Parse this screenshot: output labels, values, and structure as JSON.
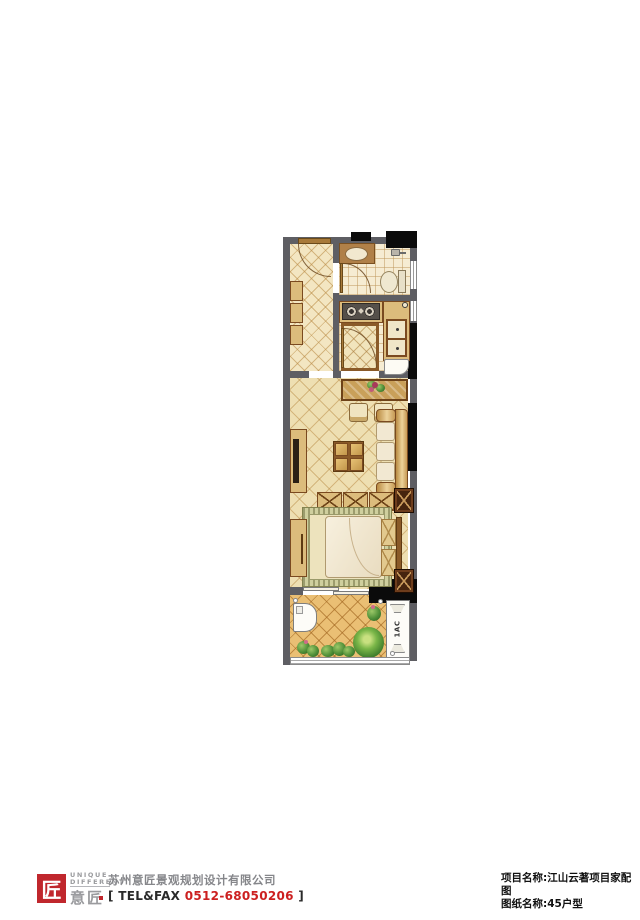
{
  "plan": {
    "ac_label": "1AC",
    "colors": {
      "wall_gray": "#5e5e63",
      "structural_black": "#0b0b0b",
      "entry_floor": "#f3e6c2",
      "living_floor": "#eedfb2",
      "bath_kitchen_tile": "#f6ecd2",
      "balcony_floor": "#eabf74",
      "tile_line": "#ba8c46",
      "wood_tan": "#dcbc7c",
      "wood_brown": "#7a4a20",
      "dark_wood": "#46240e",
      "cream": "#f2e8d2",
      "rug_olive": "#cfcf9e",
      "plant_green": "#4f8f38",
      "accent_red": "#c0272d"
    }
  },
  "footer": {
    "logo": {
      "mark_char": "匠",
      "word_top": "UNIQUE",
      "word_bottom": "DIFFERENT",
      "cjk": "意匠"
    },
    "company": "苏州意匠景观规划设计有限公司",
    "contact": {
      "bracket_open": "[",
      "telfax": "TEL&FAX",
      "number": "0512-68050206",
      "bracket_close": "]"
    }
  },
  "title_block": {
    "project_label": "项目名称:",
    "project_name": "江山云著项目家配图",
    "drawing_label": "图纸名称:",
    "drawing_name": "45户型"
  }
}
